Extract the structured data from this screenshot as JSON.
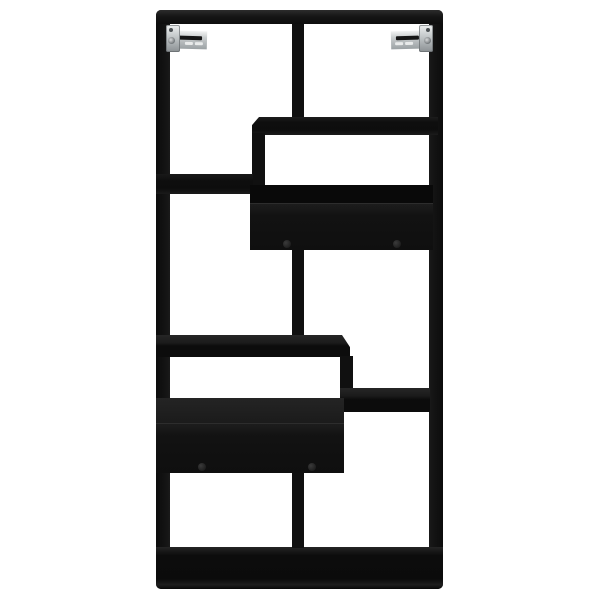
{
  "image": {
    "kind": "product-photo",
    "subject": "Black wall-mounted bookshelf",
    "alt": "Front view of a black rectangular wall shelf with eight staggered open compartments, two closed drawer niches with twin knobs, and two silver wall-mount brackets at the top corners, on a plain white background."
  },
  "colors": {
    "background": "#ffffff",
    "panel": "#101010",
    "panel_dark": "#0a0a0a",
    "panel_top_face": "#222222",
    "drawer_front": "#141414",
    "drawer_lip": "#090909",
    "knob": "#2a2a2a",
    "bracket_light": "#eef0f0",
    "bracket_mid": "#b7bcbe",
    "bracket_dark": "#8b9093",
    "bracket_slot": "#161616"
  },
  "shelf_unit": {
    "open_compartments": 8,
    "closed_drawer_niches": 2,
    "drawer_knobs": 4,
    "wall_brackets": 2,
    "material_finish": "matte black"
  }
}
